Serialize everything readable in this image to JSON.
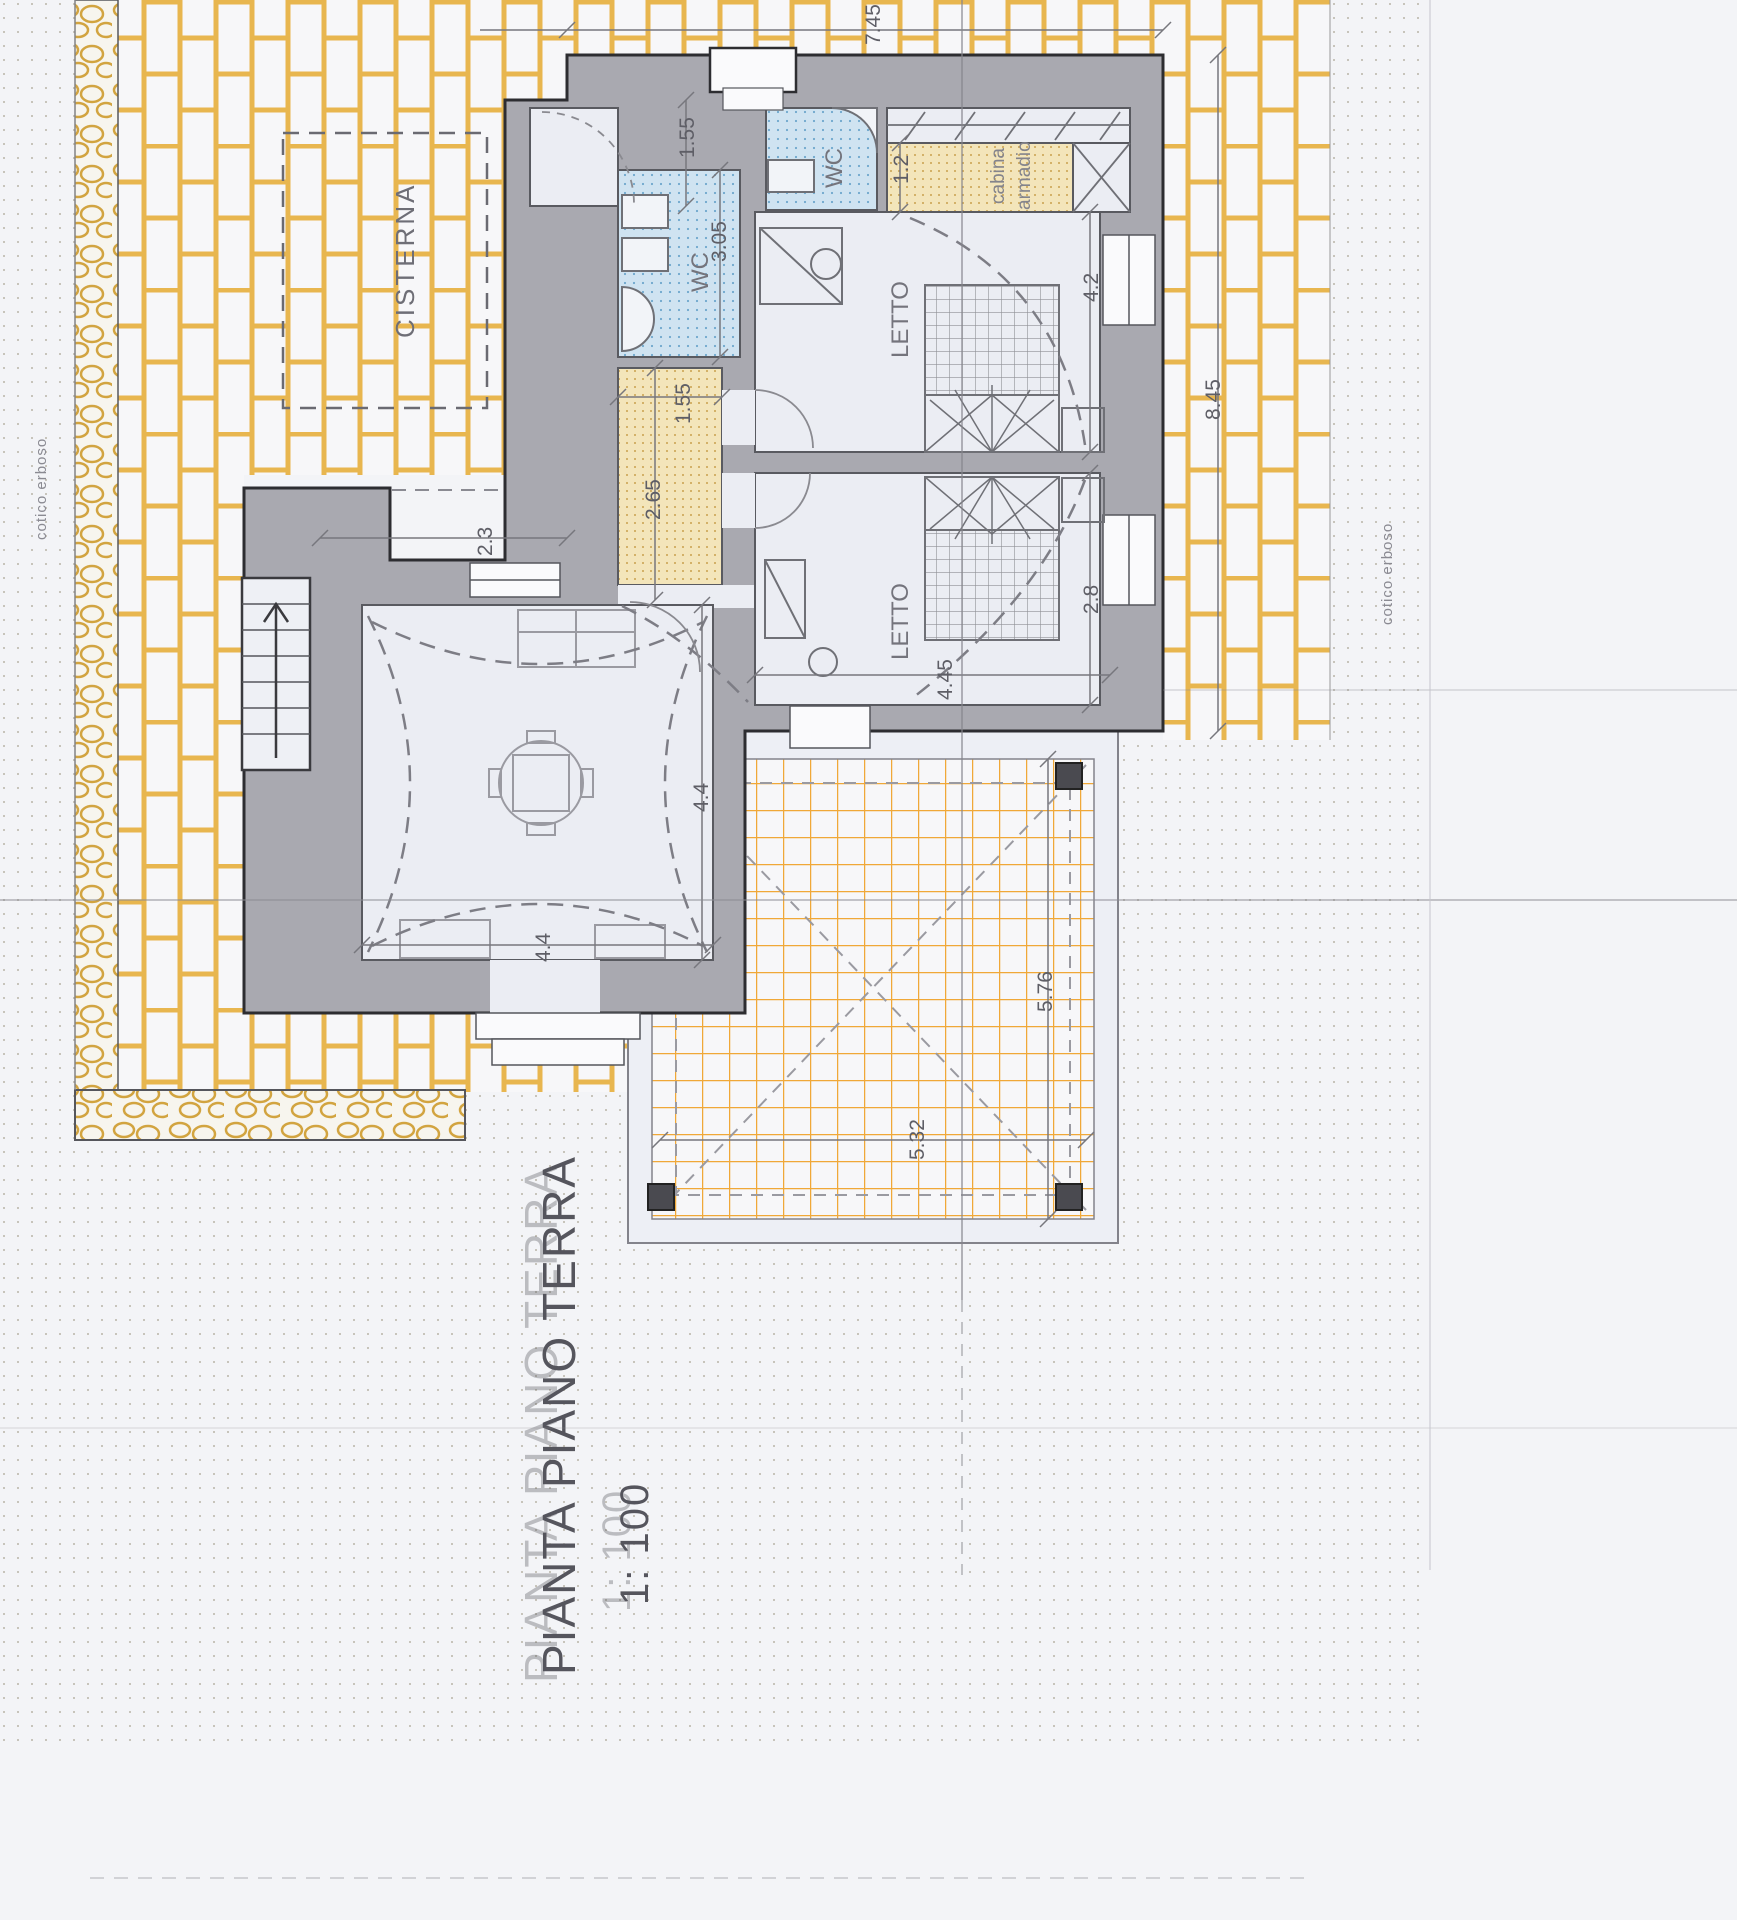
{
  "sheet": {
    "title": "PIANTA PIANO TERRA",
    "scale_label": "1: 100"
  },
  "site": {
    "cisterna_label": "CISTERNA",
    "ground_cover_left": "cotico erboso",
    "ground_cover_right": "cotico erboso"
  },
  "rooms": {
    "wc_main_label": "WC",
    "wc_small_label": "WC",
    "closet_label_line1": "cabina",
    "closet_label_line2": "armadio",
    "bedroom_top_label": "LETTO",
    "bedroom_bottom_label": "LETTO"
  },
  "dimensions": {
    "plan_width_top": "7.45",
    "plan_height_right": "8.45",
    "entry_width": "1.55",
    "wc_main_depth": "3.05",
    "closet_depth": "1.2",
    "bedroom_top_depth": "4.2",
    "bedroom_bottom_depth": "2.8",
    "bedroom_bottom_width": "4.45",
    "annex_offset": "2.3",
    "hall_width": "1.55",
    "hall_length": "2.65",
    "living_depth": "4.4",
    "living_width": "4.4",
    "pergola_depth": "5.76",
    "pergola_width": "5.32"
  },
  "colors": {
    "paper": "#f3f4f7",
    "brick_paving": "#e8b64f",
    "terrace_tile": "#f0a838",
    "wall_fill": "#a9a9b0",
    "wall_outline": "#2d2d31",
    "wc_fill": "#cfe3f1",
    "closet_fill": "#f3e5ba",
    "dim_text": "#5e5e66"
  }
}
